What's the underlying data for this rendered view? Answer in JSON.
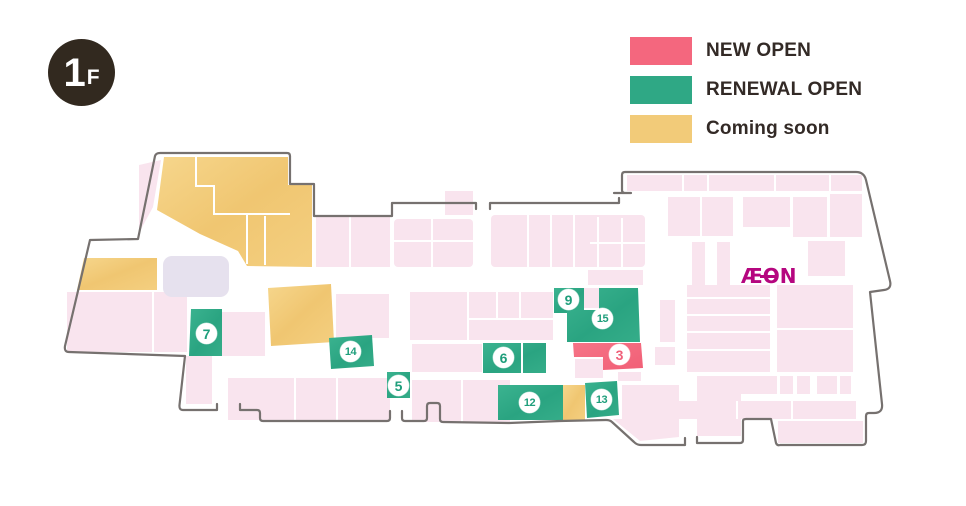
{
  "floor_badge": {
    "number": "1",
    "suffix": "F"
  },
  "legend": {
    "items": [
      {
        "key": "new-open",
        "label": "NEW OPEN",
        "color": "#f4677e"
      },
      {
        "key": "renewal-open",
        "label": "RENEWAL OPEN",
        "color": "#2fa885"
      },
      {
        "key": "coming-soon",
        "label": "Coming soon",
        "color": "#f2cb79"
      }
    ]
  },
  "map": {
    "store_logo": "ÆON",
    "markers": [
      {
        "number": "3",
        "status": "new-open"
      },
      {
        "number": "5",
        "status": "renewal-open"
      },
      {
        "number": "6",
        "status": "renewal-open"
      },
      {
        "number": "7",
        "status": "renewal-open"
      },
      {
        "number": "9",
        "status": "renewal-open"
      },
      {
        "number": "12",
        "status": "renewal-open"
      },
      {
        "number": "13",
        "status": "renewal-open"
      },
      {
        "number": "14",
        "status": "renewal-open"
      },
      {
        "number": "15",
        "status": "renewal-open"
      }
    ]
  }
}
